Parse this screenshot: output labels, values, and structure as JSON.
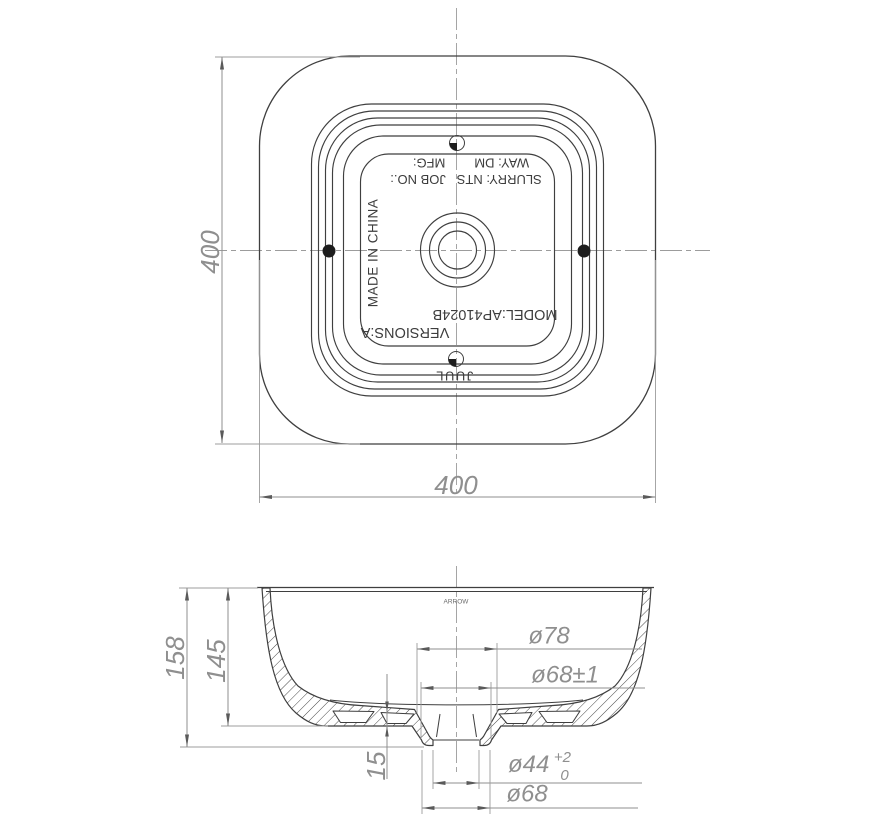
{
  "top_view": {
    "width_dim": "400",
    "height_dim": "400",
    "stamp": {
      "line_way": "WAY: DM        MFG:",
      "line_slurry": "SLURRY: NTS   JOB NO.:",
      "origin": "MADE IN CHINA",
      "model": "MODEL:AP41024B",
      "versions": "VERSIONS:A",
      "brand": "JUUL"
    }
  },
  "section_view": {
    "arrow_label": "ARROW",
    "total_height": "158",
    "bowl_height": "145",
    "base_thickness": "15",
    "top_recess_dia": "ø78",
    "mid_recess_dia": "ø68±1",
    "drain_hole_dia": "ø44",
    "drain_hole_tol_plus": "+2",
    "drain_hole_tol_minus": "0",
    "drain_boss_dia": "ø68"
  },
  "colors": {
    "line": "#3f3f3f",
    "dimension": "#8f8f8f",
    "stamp_text": "#3d3d3d",
    "background": "#ffffff"
  }
}
